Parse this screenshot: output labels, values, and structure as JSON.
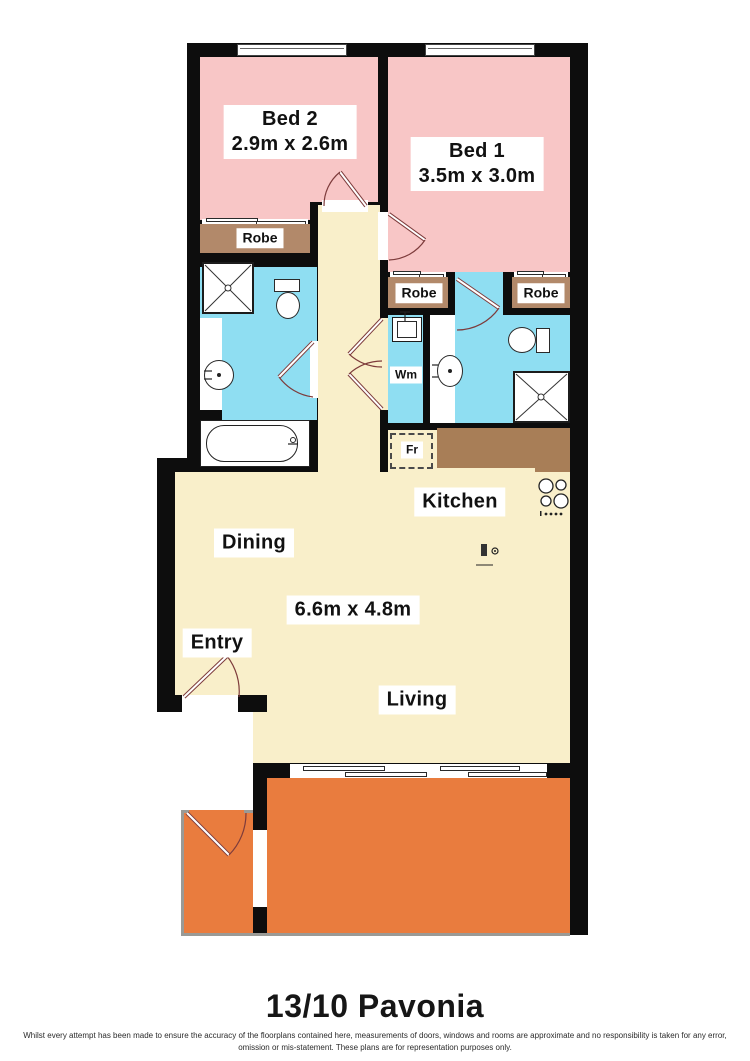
{
  "plan": {
    "title": "13/10 Pavonia",
    "disclaimer": "Whilst every attempt has been made to ensure the accuracy of the floorplans contained here, measurements of doors, windows and rooms are approximate and no responsibility is taken for any error, omission or mis-statement. These plans are for representation purposes only.",
    "rooms": {
      "bed2": {
        "name": "Bed 2",
        "dims": "2.9m x 2.6m"
      },
      "bed1": {
        "name": "Bed 1",
        "dims": "3.5m x 3.0m"
      },
      "living_area": {
        "dims": "6.6m x 4.8m"
      },
      "kitchen": {
        "name": "Kitchen"
      },
      "dining": {
        "name": "Dining"
      },
      "living": {
        "name": "Living"
      },
      "entry": {
        "name": "Entry"
      }
    },
    "fixtures": {
      "robe": "Robe",
      "wm": "Wm",
      "fr": "Fr"
    },
    "colors": {
      "bedroom_pink": "#f8c6c6",
      "floor_cream": "#f9efca",
      "bathroom_blue": "#8fdef2",
      "robe_brown": "#b2896a",
      "counter_brown": "#a87e57",
      "balcony_orange": "#e97c3e",
      "wall_black": "#0d0d0d"
    }
  }
}
